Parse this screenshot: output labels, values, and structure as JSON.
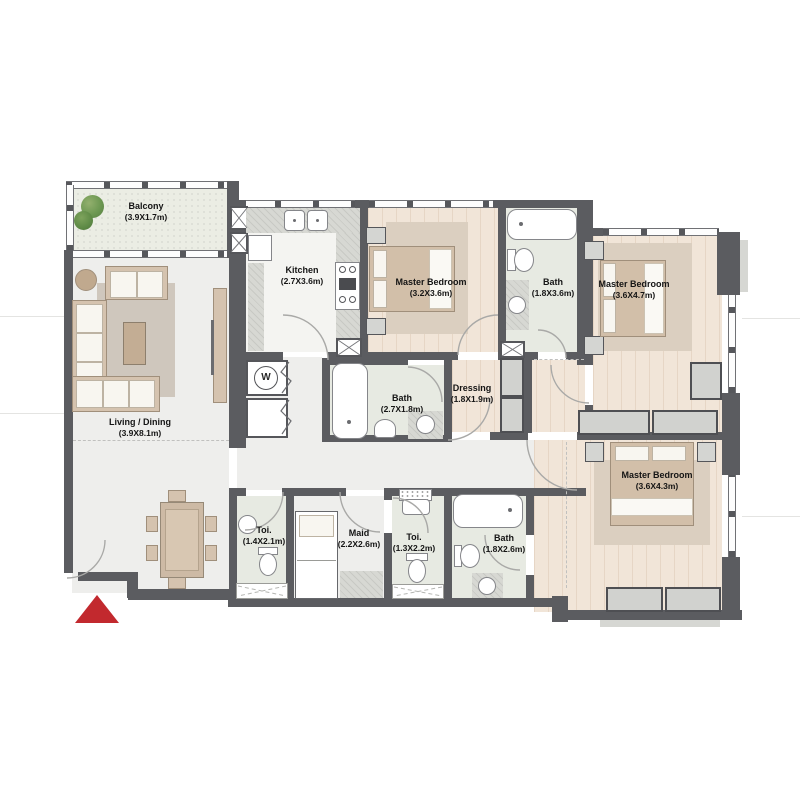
{
  "plan": {
    "rooms": [
      {
        "id": "balcony",
        "name": "Balcony",
        "dims": "(3.9X1.7m)"
      },
      {
        "id": "living-dining",
        "name": "Living / Dining",
        "dims": "(3.9X8.1m)"
      },
      {
        "id": "kitchen",
        "name": "Kitchen",
        "dims": "(2.7X3.6m)"
      },
      {
        "id": "master-bedroom-1",
        "name": "Master Bedroom",
        "dims": "(3.2X3.6m)"
      },
      {
        "id": "bath-1",
        "name": "Bath",
        "dims": "(1.8X3.6m)"
      },
      {
        "id": "master-bedroom-2",
        "name": "Master Bedroom",
        "dims": "(3.6X4.7m)"
      },
      {
        "id": "bath-2",
        "name": "Bath",
        "dims": "(2.7X1.8m)"
      },
      {
        "id": "dressing",
        "name": "Dressing",
        "dims": "(1.8X1.9m)"
      },
      {
        "id": "master-bedroom-3",
        "name": "Master Bedroom",
        "dims": "(3.6X4.3m)"
      },
      {
        "id": "toilet-1",
        "name": "Toi.",
        "dims": "(1.4X2.1m)"
      },
      {
        "id": "maid",
        "name": "Maid",
        "dims": "(2.2X2.6m)"
      },
      {
        "id": "toilet-2",
        "name": "Toi.",
        "dims": "(1.3X2.2m)"
      },
      {
        "id": "bath-3",
        "name": "Bath",
        "dims": "(1.8X2.6m)"
      }
    ],
    "fixtures": {
      "washer_label": "W"
    },
    "icons": {
      "entrance_marker": "red-triangle-up",
      "trees": "balcony-plants"
    },
    "colors": {
      "wall": "#5b5c60",
      "wood_floor": "#f1e5d8",
      "tile_floor": "#e7eae2",
      "accent_red": "#c2292e",
      "tree_green": "#6d9852"
    }
  }
}
